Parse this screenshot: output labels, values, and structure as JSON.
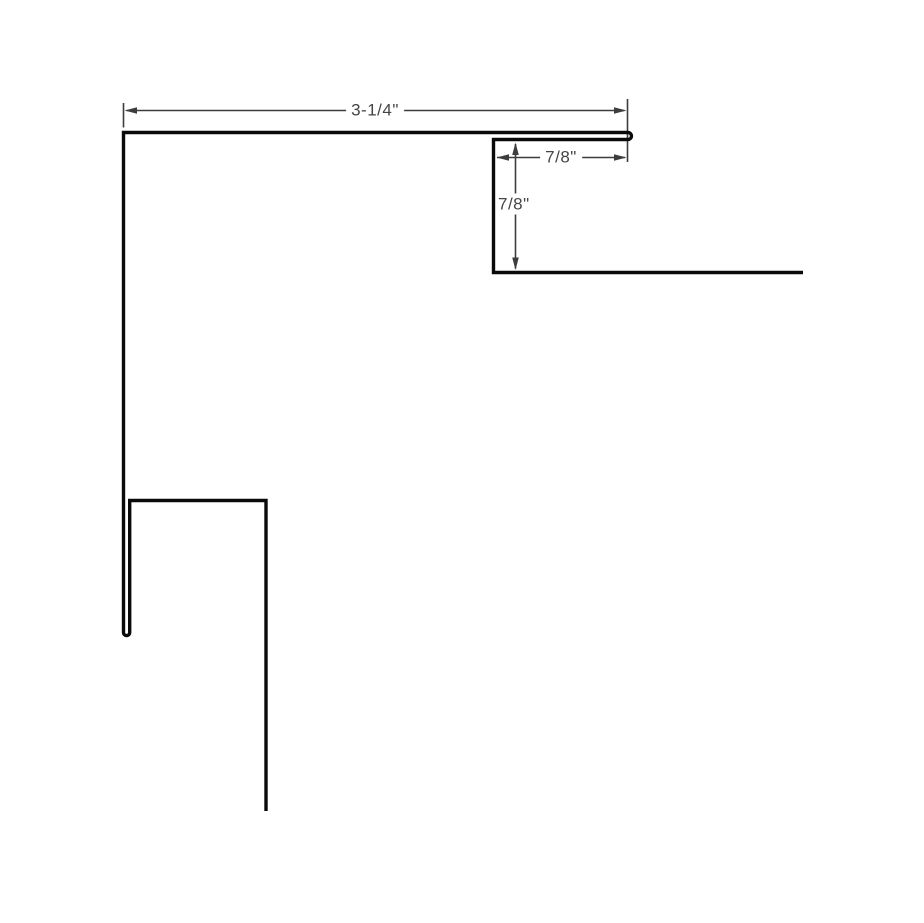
{
  "drawing": {
    "title": "trim-profile-dimension-diagram",
    "background_color": "#ffffff",
    "profile_color": "#0a0a0a",
    "dimension_color": "#3d3d3d",
    "dimensions": {
      "top_width": "3-1/4\"",
      "hem_width": "7/8\"",
      "hem_height": "7/8\""
    }
  }
}
